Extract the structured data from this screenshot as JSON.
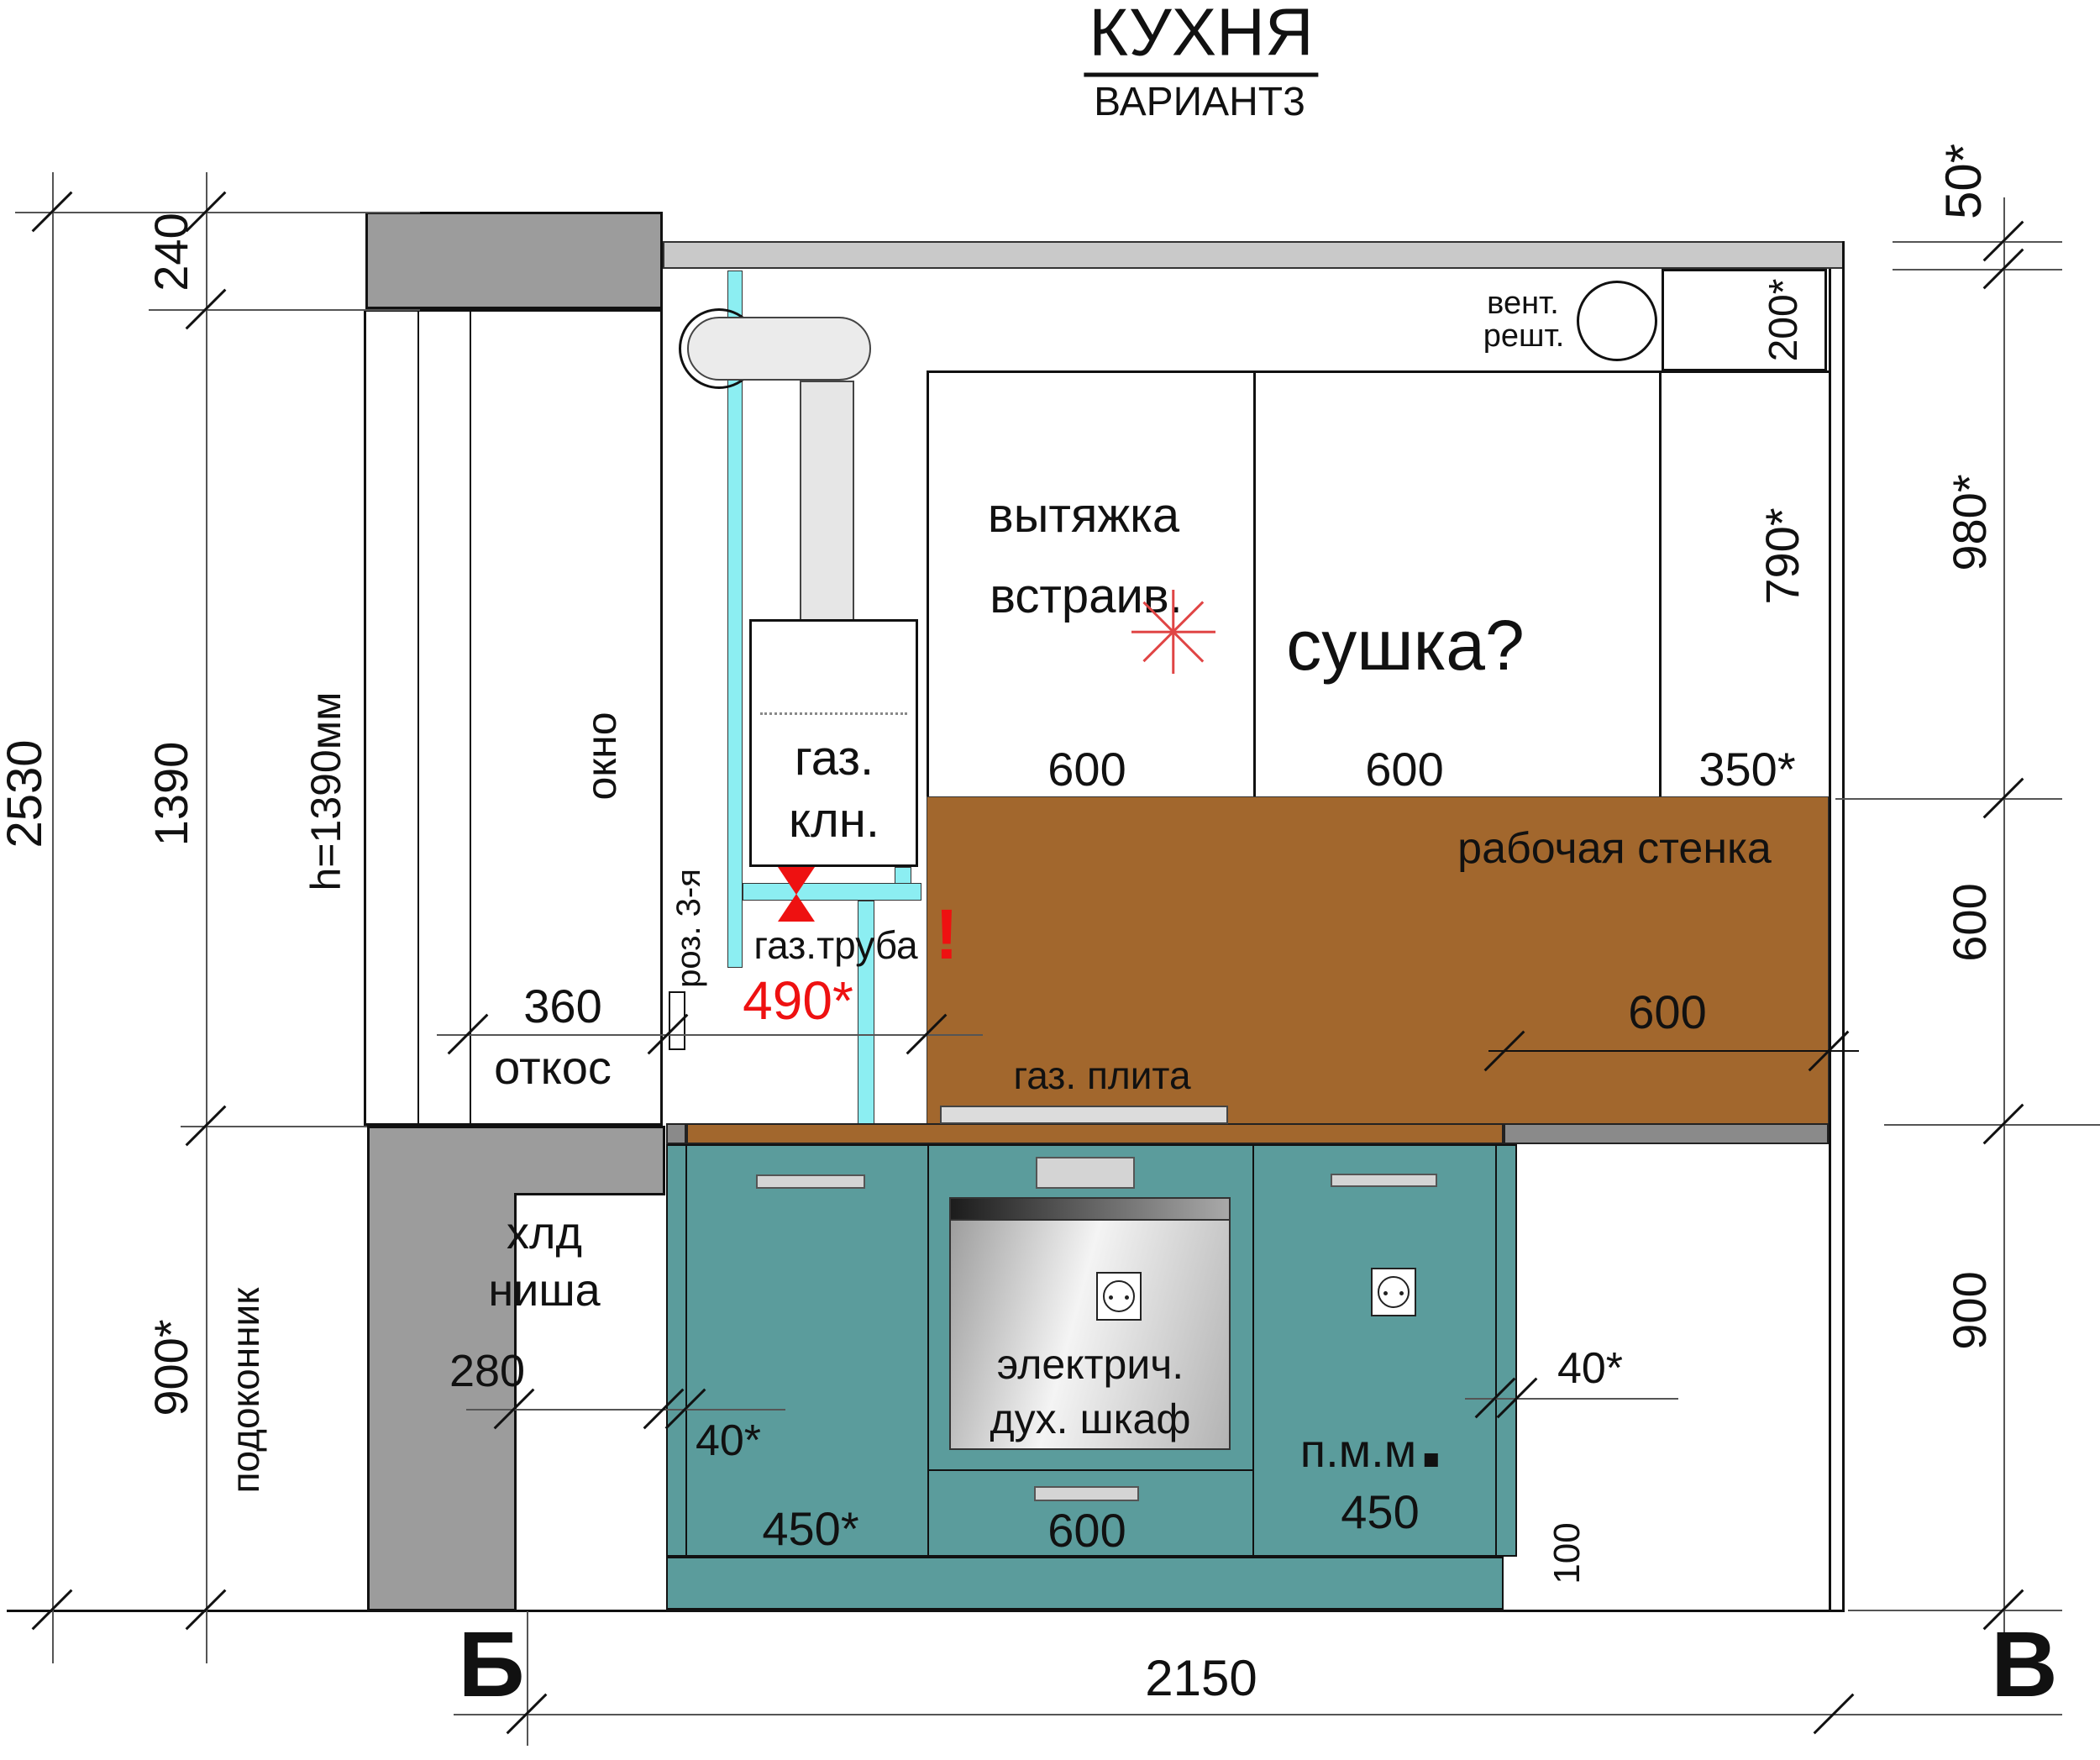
{
  "title": {
    "main": "КУХНЯ",
    "variant": "ВАРИАНТ3"
  },
  "colors": {
    "cabinet_teal": "#5b9c9c",
    "backsplash_brown": "#a2672d",
    "wall_gray": "#9c9c9c",
    "ceiling_gray": "#c9c9c9",
    "counter_gray": "#8a8a8a",
    "pipe_cyan": "#8ceef2",
    "accent_red": "#ee1111"
  },
  "dims": {
    "left": {
      "overall": "2530",
      "lintel": "240",
      "window": "1390",
      "sill": "900*"
    },
    "right": {
      "ceiling_gap": "50*",
      "upper": "980*",
      "vent_box": "200*",
      "tall_cabinet": "790*",
      "backsplash_h": "600",
      "base_h": "900"
    },
    "top_cabinets": {
      "hood_w": "600",
      "dry_w": "600",
      "tall_w": "350*"
    },
    "middle": {
      "slope": "360",
      "slope_word": "откос",
      "gas_offset": "490*",
      "wall_600": "600"
    },
    "base": {
      "niche_w": "280",
      "gap_left": "40*",
      "door1_w": "450*",
      "oven_w": "600",
      "pmm_w": "450",
      "gap_right": "40*",
      "plinth_h": "100",
      "total": "2150"
    }
  },
  "texts": {
    "podokonnik": "подоконник",
    "window_h": "h=1390мм",
    "okno": "окно",
    "vent_line1": "вент.",
    "vent_line2": "решт.",
    "hood_line1": "вытяжка",
    "hood_line2": "встраив.",
    "sushka": "сушка?",
    "rab_stenka": "рабочая стенка",
    "warn": "!",
    "boiler_line1": "газ.",
    "boiler_line2": "клн.",
    "gas_pipe": "газ.труба",
    "socket_note": "роз. 3-я",
    "stove": "газ. плита",
    "niche_line1": "хлд",
    "niche_line2": "ниша",
    "oven_line1": "электрич.",
    "oven_line2": "дух. шкаф",
    "pmm": "п.м.м",
    "axis_left": "Б",
    "axis_right": "В"
  }
}
